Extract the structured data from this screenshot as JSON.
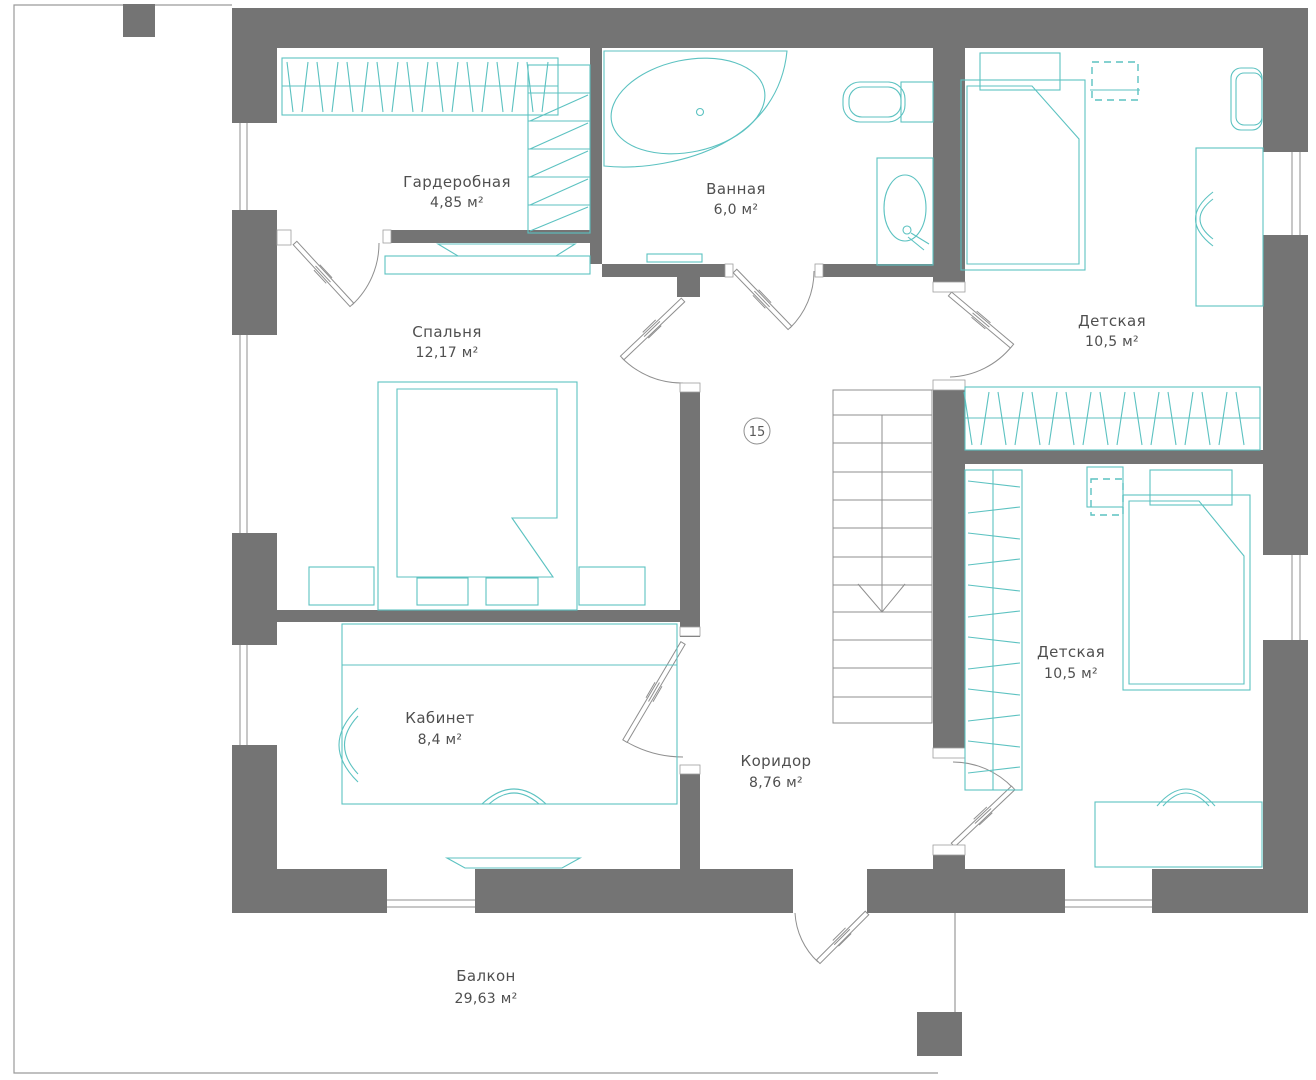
{
  "plan": {
    "marker": "15",
    "rooms": [
      {
        "id": "wardrobe",
        "name": "Гардеробная",
        "area": "4,85 м²"
      },
      {
        "id": "bathroom",
        "name": "Ванная",
        "area": "6,0 м²"
      },
      {
        "id": "bedroom",
        "name": "Спальня",
        "area": "12,17 м²"
      },
      {
        "id": "nursery-top",
        "name": "Детская",
        "area": "10,5 м²"
      },
      {
        "id": "nursery-bottom",
        "name": "Детская",
        "area": "10,5 м²"
      },
      {
        "id": "office",
        "name": "Кабинет",
        "area": "8,4 м²"
      },
      {
        "id": "corridor",
        "name": "Коридор",
        "area": "8,76 м²"
      },
      {
        "id": "balcony",
        "name": "Балкон",
        "area": "29,63 м²"
      }
    ]
  },
  "colors": {
    "wall": "#747474",
    "furniture": "#5cc2c1",
    "door_line": "#8f8f8f",
    "label": "#4f4f4f",
    "background": "#ffffff"
  }
}
